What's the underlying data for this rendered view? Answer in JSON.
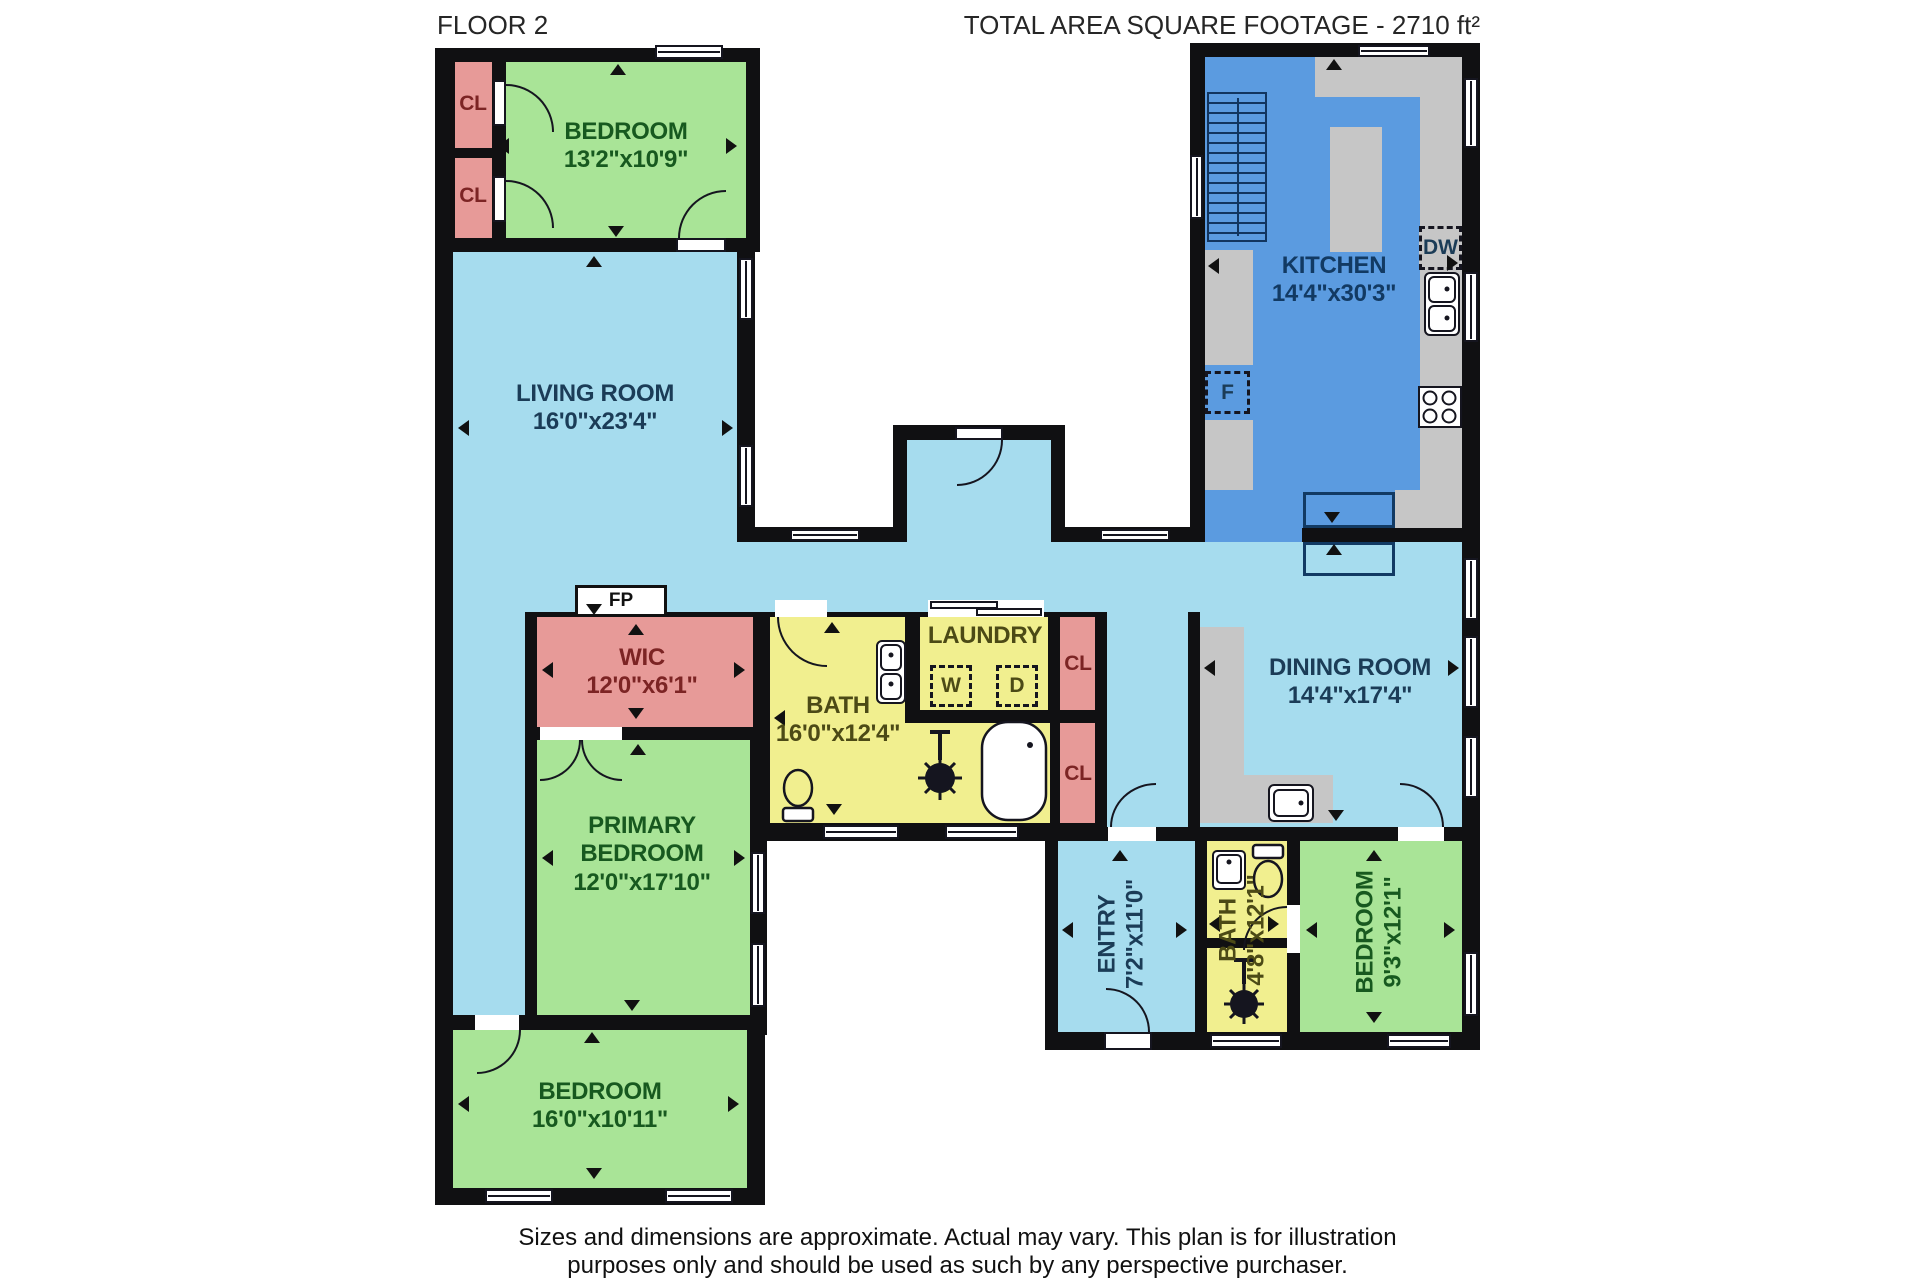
{
  "header": {
    "floor": "FLOOR 2",
    "total_area": "TOTAL AREA SQUARE FOOTAGE - 2710 ft²"
  },
  "rooms": {
    "bedroom_top_left": {
      "name": "BEDROOM",
      "dims": "13'2\"x10'9\""
    },
    "living": {
      "name": "LIVING ROOM",
      "dims": "16'0\"x23'4\""
    },
    "kitchen": {
      "name": "KITCHEN",
      "dims": "14'4\"x30'3\""
    },
    "wic": {
      "name": "WIC",
      "dims": "12'0\"x6'1\""
    },
    "bath_main": {
      "name": "BATH",
      "dims": "16'0\"x12'4\""
    },
    "laundry": {
      "name": "LAUNDRY"
    },
    "dining": {
      "name": "DINING ROOM",
      "dims": "14'4\"x17'4\""
    },
    "primary": {
      "name1": "PRIMARY",
      "name2": "BEDROOM",
      "dims": "12'0\"x17'10\""
    },
    "bedroom_bottom_left": {
      "name": "BEDROOM",
      "dims": "16'0\"x10'11\""
    },
    "entry": {
      "name": "ENTRY",
      "dims": "7'2\"x11'0\""
    },
    "bath_small": {
      "name": "BATH",
      "dims": "4'8\"x12'1\""
    },
    "bedroom_bottom_right": {
      "name": "BEDROOM",
      "dims": "9'3\"x12'1\""
    }
  },
  "labels": {
    "closet": "CL",
    "fireplace": "FP",
    "fridge": "F",
    "dishwasher": "DW",
    "washer": "W",
    "dryer": "D"
  },
  "footer": {
    "line1": "Sizes and dimensions are approximate. Actual may vary. This plan is for illustration",
    "line2": "purposes only and should be used as such by any perspective purchaser."
  },
  "colors": {
    "wall": "#101012",
    "light_blue": "#a6dcee",
    "kitchen_blue": "#5b9be0",
    "green": "#a9e497",
    "pink": "#e79a98",
    "yellow": "#f1ef8f",
    "counter_gray": "#c6c6c6",
    "text_blue": "#1b3c57",
    "text_green": "#17591f",
    "text_red": "#7c2424",
    "text_yellow": "#4c4a16",
    "text_dark": "#1c1c1c"
  }
}
